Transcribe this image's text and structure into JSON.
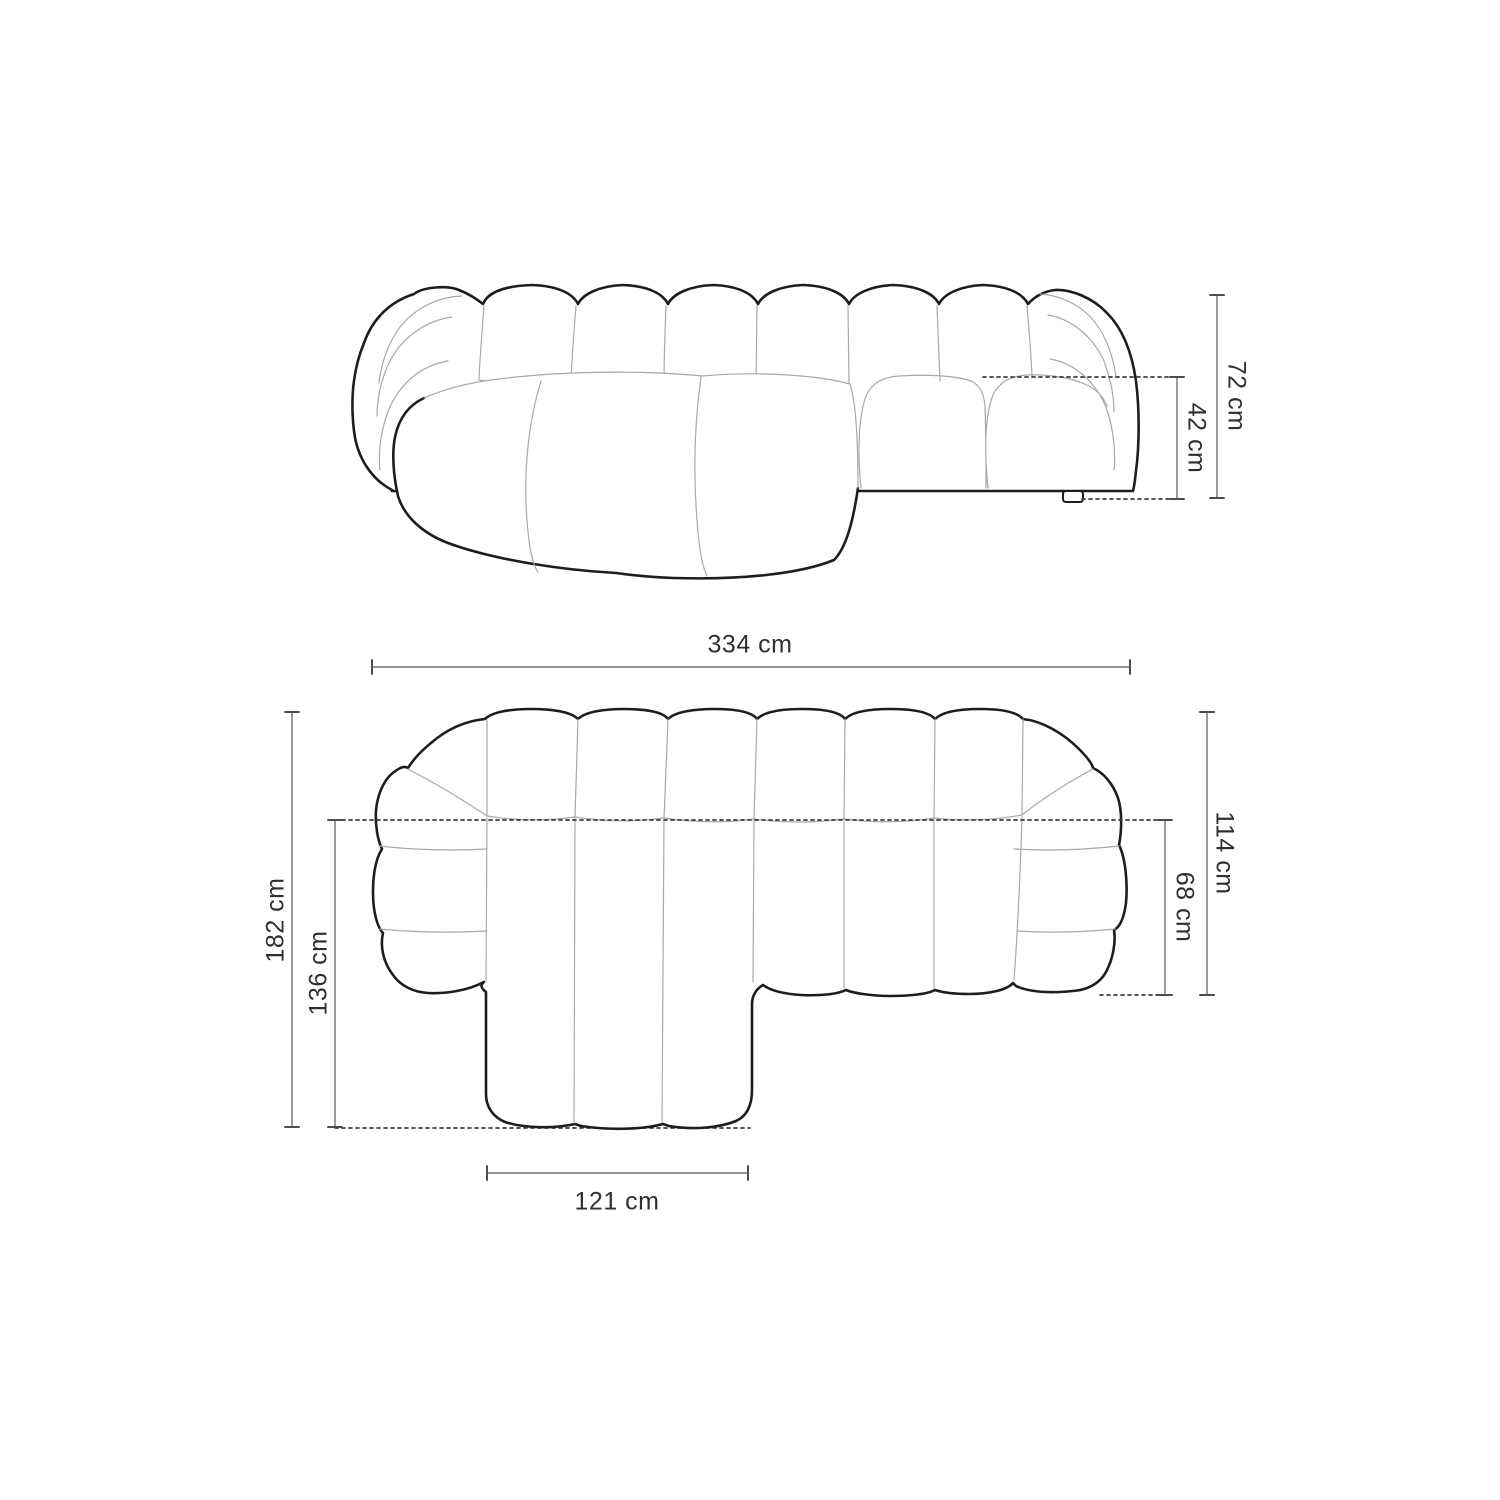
{
  "diagram": {
    "subject": "sectional-sofa-with-left-chaise",
    "views": {
      "front_view": "front elevation",
      "top_view": "top plan"
    },
    "colors": {
      "background": "#ffffff",
      "outline_bold": "#1d1d1d",
      "outline_light": "#a8a8a8",
      "dimension_line": "#8a8a8a",
      "dimension_tick": "#4d4d4d",
      "dashed_line": "#3f3f3f",
      "text": "#2f2f2f"
    }
  },
  "dimensions": {
    "total_height": {
      "label": "72 cm"
    },
    "seat_height": {
      "label": "42 cm"
    },
    "total_width": {
      "label": "334 cm"
    },
    "total_depth": {
      "label": "182 cm"
    },
    "chaise_depth": {
      "label": "136 cm"
    },
    "main_depth": {
      "label": "114 cm"
    },
    "seat_depth": {
      "label": "68 cm"
    },
    "chaise_width": {
      "label": "121 cm"
    }
  }
}
